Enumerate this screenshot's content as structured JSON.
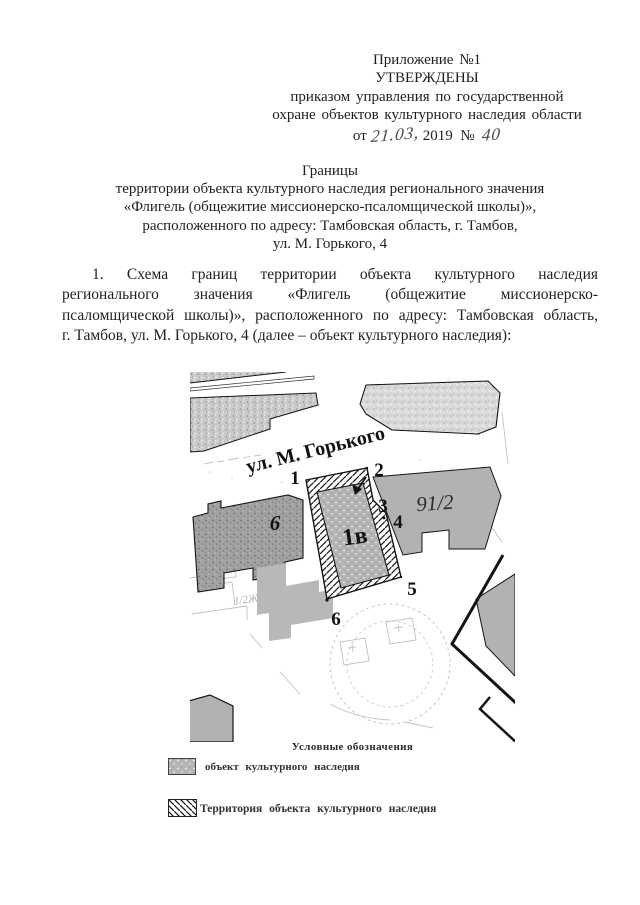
{
  "header": {
    "lines": [
      "Приложение №1",
      "УТВЕРЖДЕНЫ",
      "приказом управления по государственной",
      "охране объектов культурного наследия области"
    ],
    "date_line": {
      "prefix": "от",
      "date_handwritten": "21.03,",
      "year": "2019",
      "no_sign": "№",
      "number_handwritten": "40"
    }
  },
  "title": {
    "lines": [
      "Границы",
      "территории объекта культурного наследия регионального значения",
      "«Флигель (общежитие миссионерско-псаломщической школы)»,",
      "расположенного по адресу: Тамбовская  область, г. Тамбов,",
      "ул. М. Горького, 4"
    ]
  },
  "paragraph": {
    "lines": [
      "1. Схема границ территории объекта культурного наследия",
      "регионального значения «Флигель (общежитие миссионерско-",
      "псаломщической школы)», расположенного по адресу: Тамбовская  область,",
      "г. Тамбов, ул. М. Горького, 4 (далее – объект культурного наследия):"
    ]
  },
  "map": {
    "street_label": "ул. М. Горького",
    "point_labels": [
      "1",
      "2",
      "3",
      "4",
      "5",
      "6"
    ],
    "object_label": "1в",
    "neighbor_building_label": "6",
    "parcel_label": "91/2",
    "faint_parcel_label": "1/2Ж"
  },
  "legend": {
    "title": "Условные обозначения",
    "items": [
      {
        "swatch": "gray-stipple",
        "label": "объект культурного наследия"
      },
      {
        "swatch": "diagonal-hatch",
        "label": "Территория объекта культурного наследия"
      }
    ]
  },
  "colors": {
    "text": "#1f1f1f",
    "map_outline": "#141414",
    "building_flat_gray": "#b2b2b2",
    "building_stipple_gray": "#c9c9c9",
    "building_dark_gray": "#a2a2a2",
    "hatch_line": "#141414"
  }
}
